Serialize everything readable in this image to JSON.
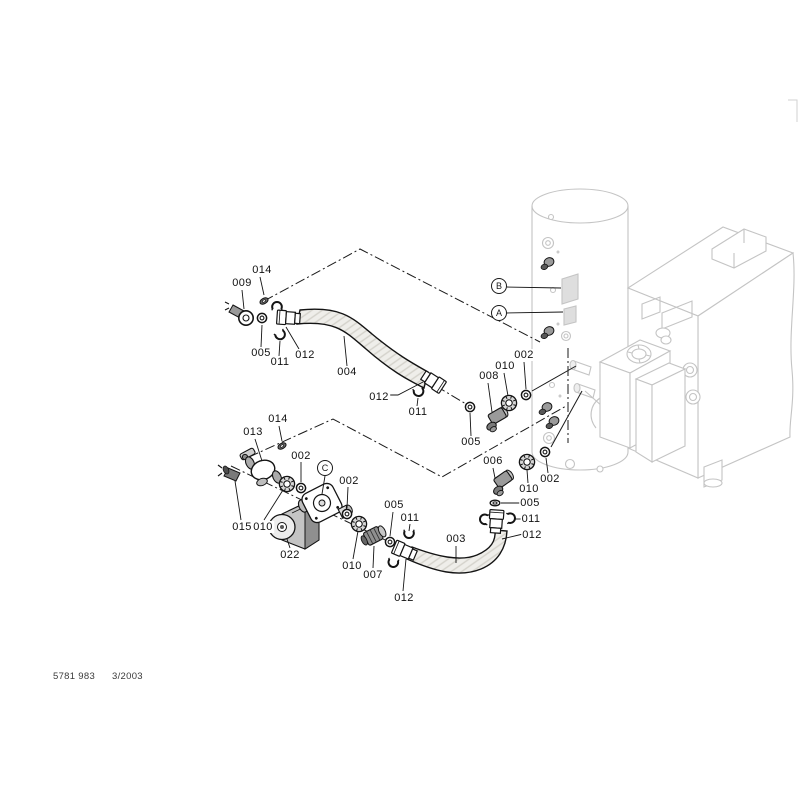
{
  "colors": {
    "diagram_line": "#1a1a1a",
    "equipment_line": "#c4c4c4",
    "label_plate_fill": "#dedede",
    "hose_fill": "#efeeea",
    "text": "#111111"
  },
  "footer": {
    "doc_number": "5781 983",
    "revision_date": "3/2003"
  },
  "reference_markers": [
    {
      "label": "B",
      "x": 499,
      "y": 286
    },
    {
      "label": "A",
      "x": 499,
      "y": 313
    },
    {
      "label": "C",
      "x": 325,
      "y": 468
    }
  ],
  "part_callouts": [
    {
      "label": "014",
      "x": 262,
      "y": 270
    },
    {
      "label": "009",
      "x": 242,
      "y": 283
    },
    {
      "label": "005",
      "x": 261,
      "y": 353
    },
    {
      "label": "011",
      "x": 280,
      "y": 362
    },
    {
      "label": "012",
      "x": 305,
      "y": 355
    },
    {
      "label": "004",
      "x": 347,
      "y": 372
    },
    {
      "label": "012",
      "x": 379,
      "y": 397
    },
    {
      "label": "011",
      "x": 418,
      "y": 412
    },
    {
      "label": "002",
      "x": 524,
      "y": 355
    },
    {
      "label": "010",
      "x": 505,
      "y": 366
    },
    {
      "label": "008",
      "x": 489,
      "y": 376
    },
    {
      "label": "005",
      "x": 471,
      "y": 442
    },
    {
      "label": "013",
      "x": 253,
      "y": 432
    },
    {
      "label": "014",
      "x": 278,
      "y": 419
    },
    {
      "label": "002",
      "x": 301,
      "y": 456
    },
    {
      "label": "002",
      "x": 349,
      "y": 481
    },
    {
      "label": "015",
      "x": 242,
      "y": 527
    },
    {
      "label": "010",
      "x": 263,
      "y": 527
    },
    {
      "label": "022",
      "x": 290,
      "y": 555
    },
    {
      "label": "010",
      "x": 352,
      "y": 566
    },
    {
      "label": "007",
      "x": 373,
      "y": 575
    },
    {
      "label": "005",
      "x": 394,
      "y": 505
    },
    {
      "label": "011",
      "x": 410,
      "y": 518
    },
    {
      "label": "003",
      "x": 456,
      "y": 539
    },
    {
      "label": "012",
      "x": 404,
      "y": 598
    },
    {
      "label": "006",
      "x": 493,
      "y": 461
    },
    {
      "label": "010",
      "x": 529,
      "y": 489
    },
    {
      "label": "002",
      "x": 550,
      "y": 479
    },
    {
      "label": "005",
      "x": 530,
      "y": 503
    },
    {
      "label": "011",
      "x": 531,
      "y": 519
    },
    {
      "label": "012",
      "x": 532,
      "y": 535
    }
  ]
}
